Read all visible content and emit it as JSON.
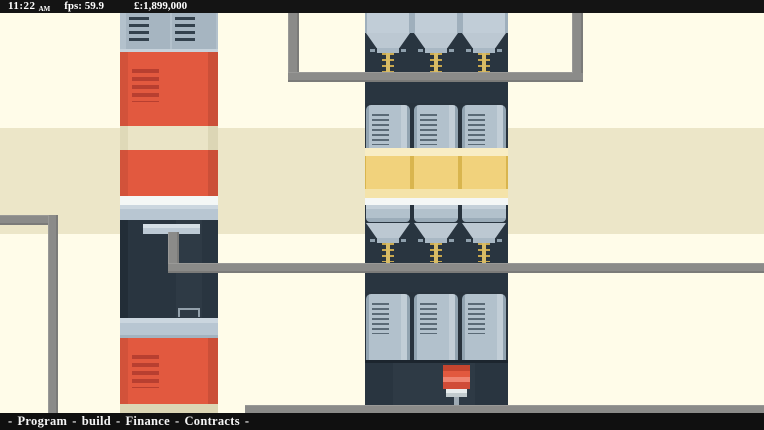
{
  "hud": {
    "time": "11:22",
    "time_suffix": "AM",
    "fps": "fps: 59.9",
    "money": "£:1,899,000"
  },
  "menu": {
    "separator": "-",
    "items": [
      "Program",
      "build",
      "Finance",
      "Contracts"
    ]
  },
  "colors": {
    "background": "#FFFCE9",
    "floor_band": "#ECE6C8",
    "hud_bar": "#141414",
    "hud_text": "#FFFFFF",
    "machine_red": "#E2593F",
    "machine_navy": "#293540",
    "machine_steel": "#B3C1CC",
    "band_yellow": "#EFC85E",
    "gold_bit": "#C9A84E",
    "drill_red": "#D04C38",
    "pipe_gray": "#8B8B89"
  }
}
